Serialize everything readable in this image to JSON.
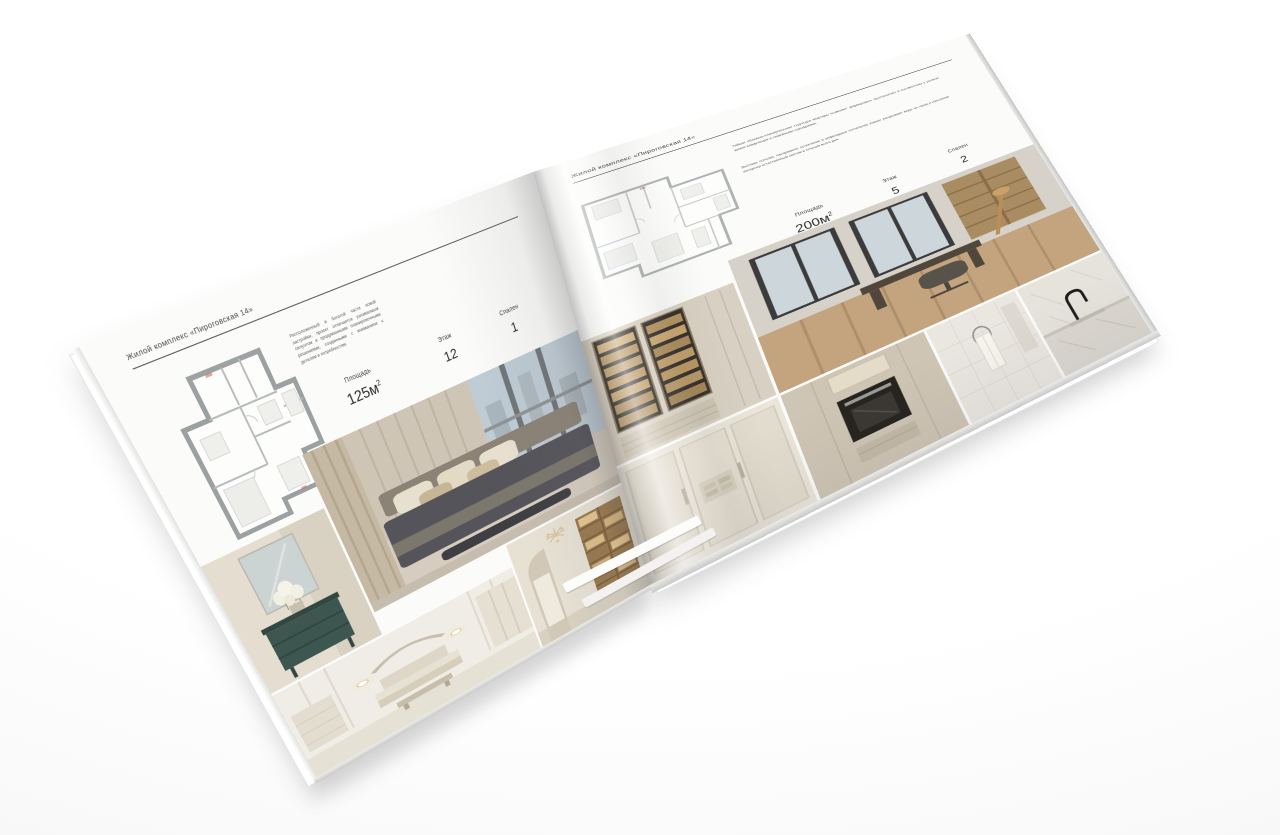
{
  "scene": {
    "background_color": "#ffffff",
    "paper_color": "#fbfbf9",
    "text_color": "#3a3a3a"
  },
  "left_page": {
    "header": "Жилой комплекс «Пироговская 14»",
    "description": "Расположенный в богатой части новой застройки, проект отличается узнаваемым силуэтом и продуманными планировочными решениями, созданными с вниманием к деталям и потребностям.",
    "stats": [
      {
        "label": "Площадь",
        "value": "125м",
        "sup": "2"
      },
      {
        "label": "Этаж",
        "value": "12"
      },
      {
        "label": "Спален",
        "value": "1"
      }
    ],
    "floor_plan": "floor-plan-125",
    "photos": [
      "master-bedroom",
      "dresser-with-flowers",
      "bedroom-with-bench",
      "hallway-with-chandelier"
    ]
  },
  "right_page": {
    "header": "Жилой комплекс «Пироговская 14»",
    "description_1": "Гибкая объемно-планировочная структура квартиры позволяет формировать пространство в соответствии с ритмом жизни владельцев и семейными сценариями.",
    "description_2": "Высокие потолки, панорамное остекление и анфиладное построение комнат раскрывают виды на город и наполняют интерьер естественным светом в течение всего дня.",
    "stats": [
      {
        "label": "Площадь",
        "value": "200м",
        "sup": "2"
      },
      {
        "label": "Этаж",
        "value": "5"
      },
      {
        "label": "Спален",
        "value": "2"
      }
    ],
    "floor_plan": "floor-plan-200",
    "photos": [
      "display-cabinets",
      "study-with-desk",
      "light-closet",
      "built-in-oven",
      "bathroom-towel",
      "kitchen-faucet"
    ]
  }
}
